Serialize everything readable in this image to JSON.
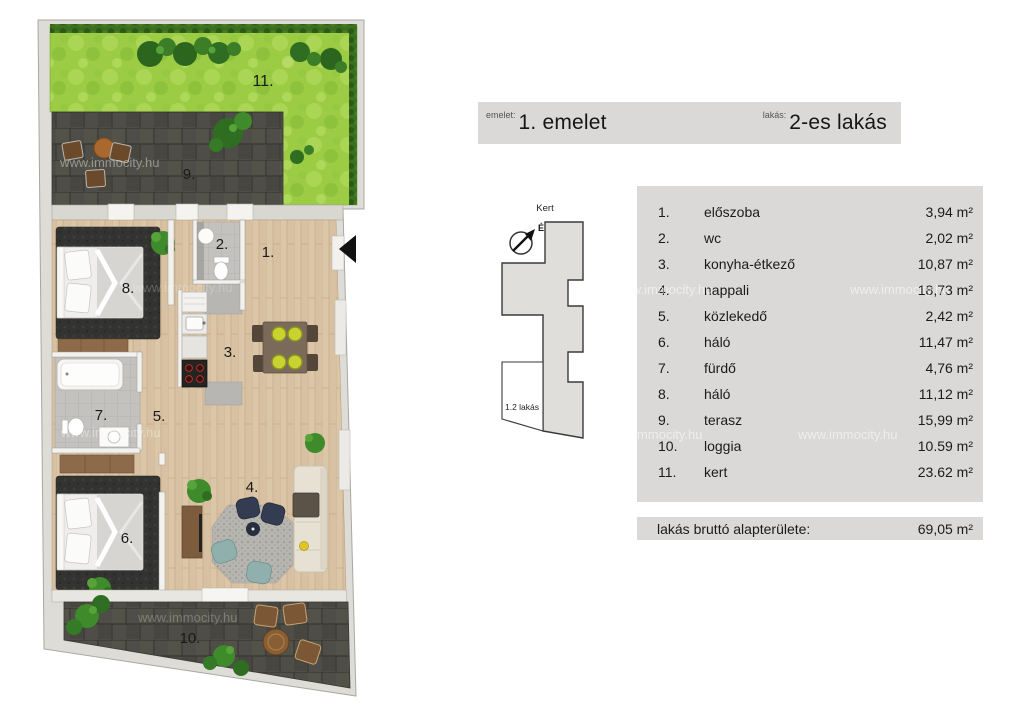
{
  "header": {
    "floor_label": "emelet:",
    "floor_value": "1. emelet",
    "unit_label": "lakás:",
    "unit_value": "2-es lakás"
  },
  "keyplan": {
    "garden_label": "Kert",
    "north_label": "É",
    "unit_label": "1.2 lakás"
  },
  "rooms": [
    {
      "num": "1.",
      "name": "előszoba",
      "area": "3,94 m²"
    },
    {
      "num": "2.",
      "name": "wc",
      "area": "2,02 m²"
    },
    {
      "num": "3.",
      "name": "konyha-étkező",
      "area": "10,87 m²"
    },
    {
      "num": "4.",
      "name": "nappali",
      "area": "18,73 m²"
    },
    {
      "num": "5.",
      "name": "közlekedő",
      "area": "2,42 m²"
    },
    {
      "num": "6.",
      "name": "háló",
      "area": "11,47 m²"
    },
    {
      "num": "7.",
      "name": "fürdő",
      "area": "4,76 m²"
    },
    {
      "num": "8.",
      "name": "háló",
      "area": "11,12 m²"
    },
    {
      "num": "9.",
      "name": "terasz",
      "area": "15,99 m²"
    },
    {
      "num": "10.",
      "name": "loggia",
      "area": "10.59 m²"
    },
    {
      "num": "11.",
      "name": "kert",
      "area": "23.62 m²"
    }
  ],
  "summary": {
    "label": "lakás bruttó alapterülete:",
    "value": "69,05 m²"
  },
  "watermark": "www.immocity.hu",
  "colors": {
    "garden_green": "#9ccb44",
    "hedge_green": "#3c7020",
    "terrace_tile": "#4e4d47",
    "wood_floor": "#dcc6a8",
    "panel_gray": "#dad9d7",
    "wall_gray": "#dedcd7",
    "arrow_black": "#111111"
  }
}
